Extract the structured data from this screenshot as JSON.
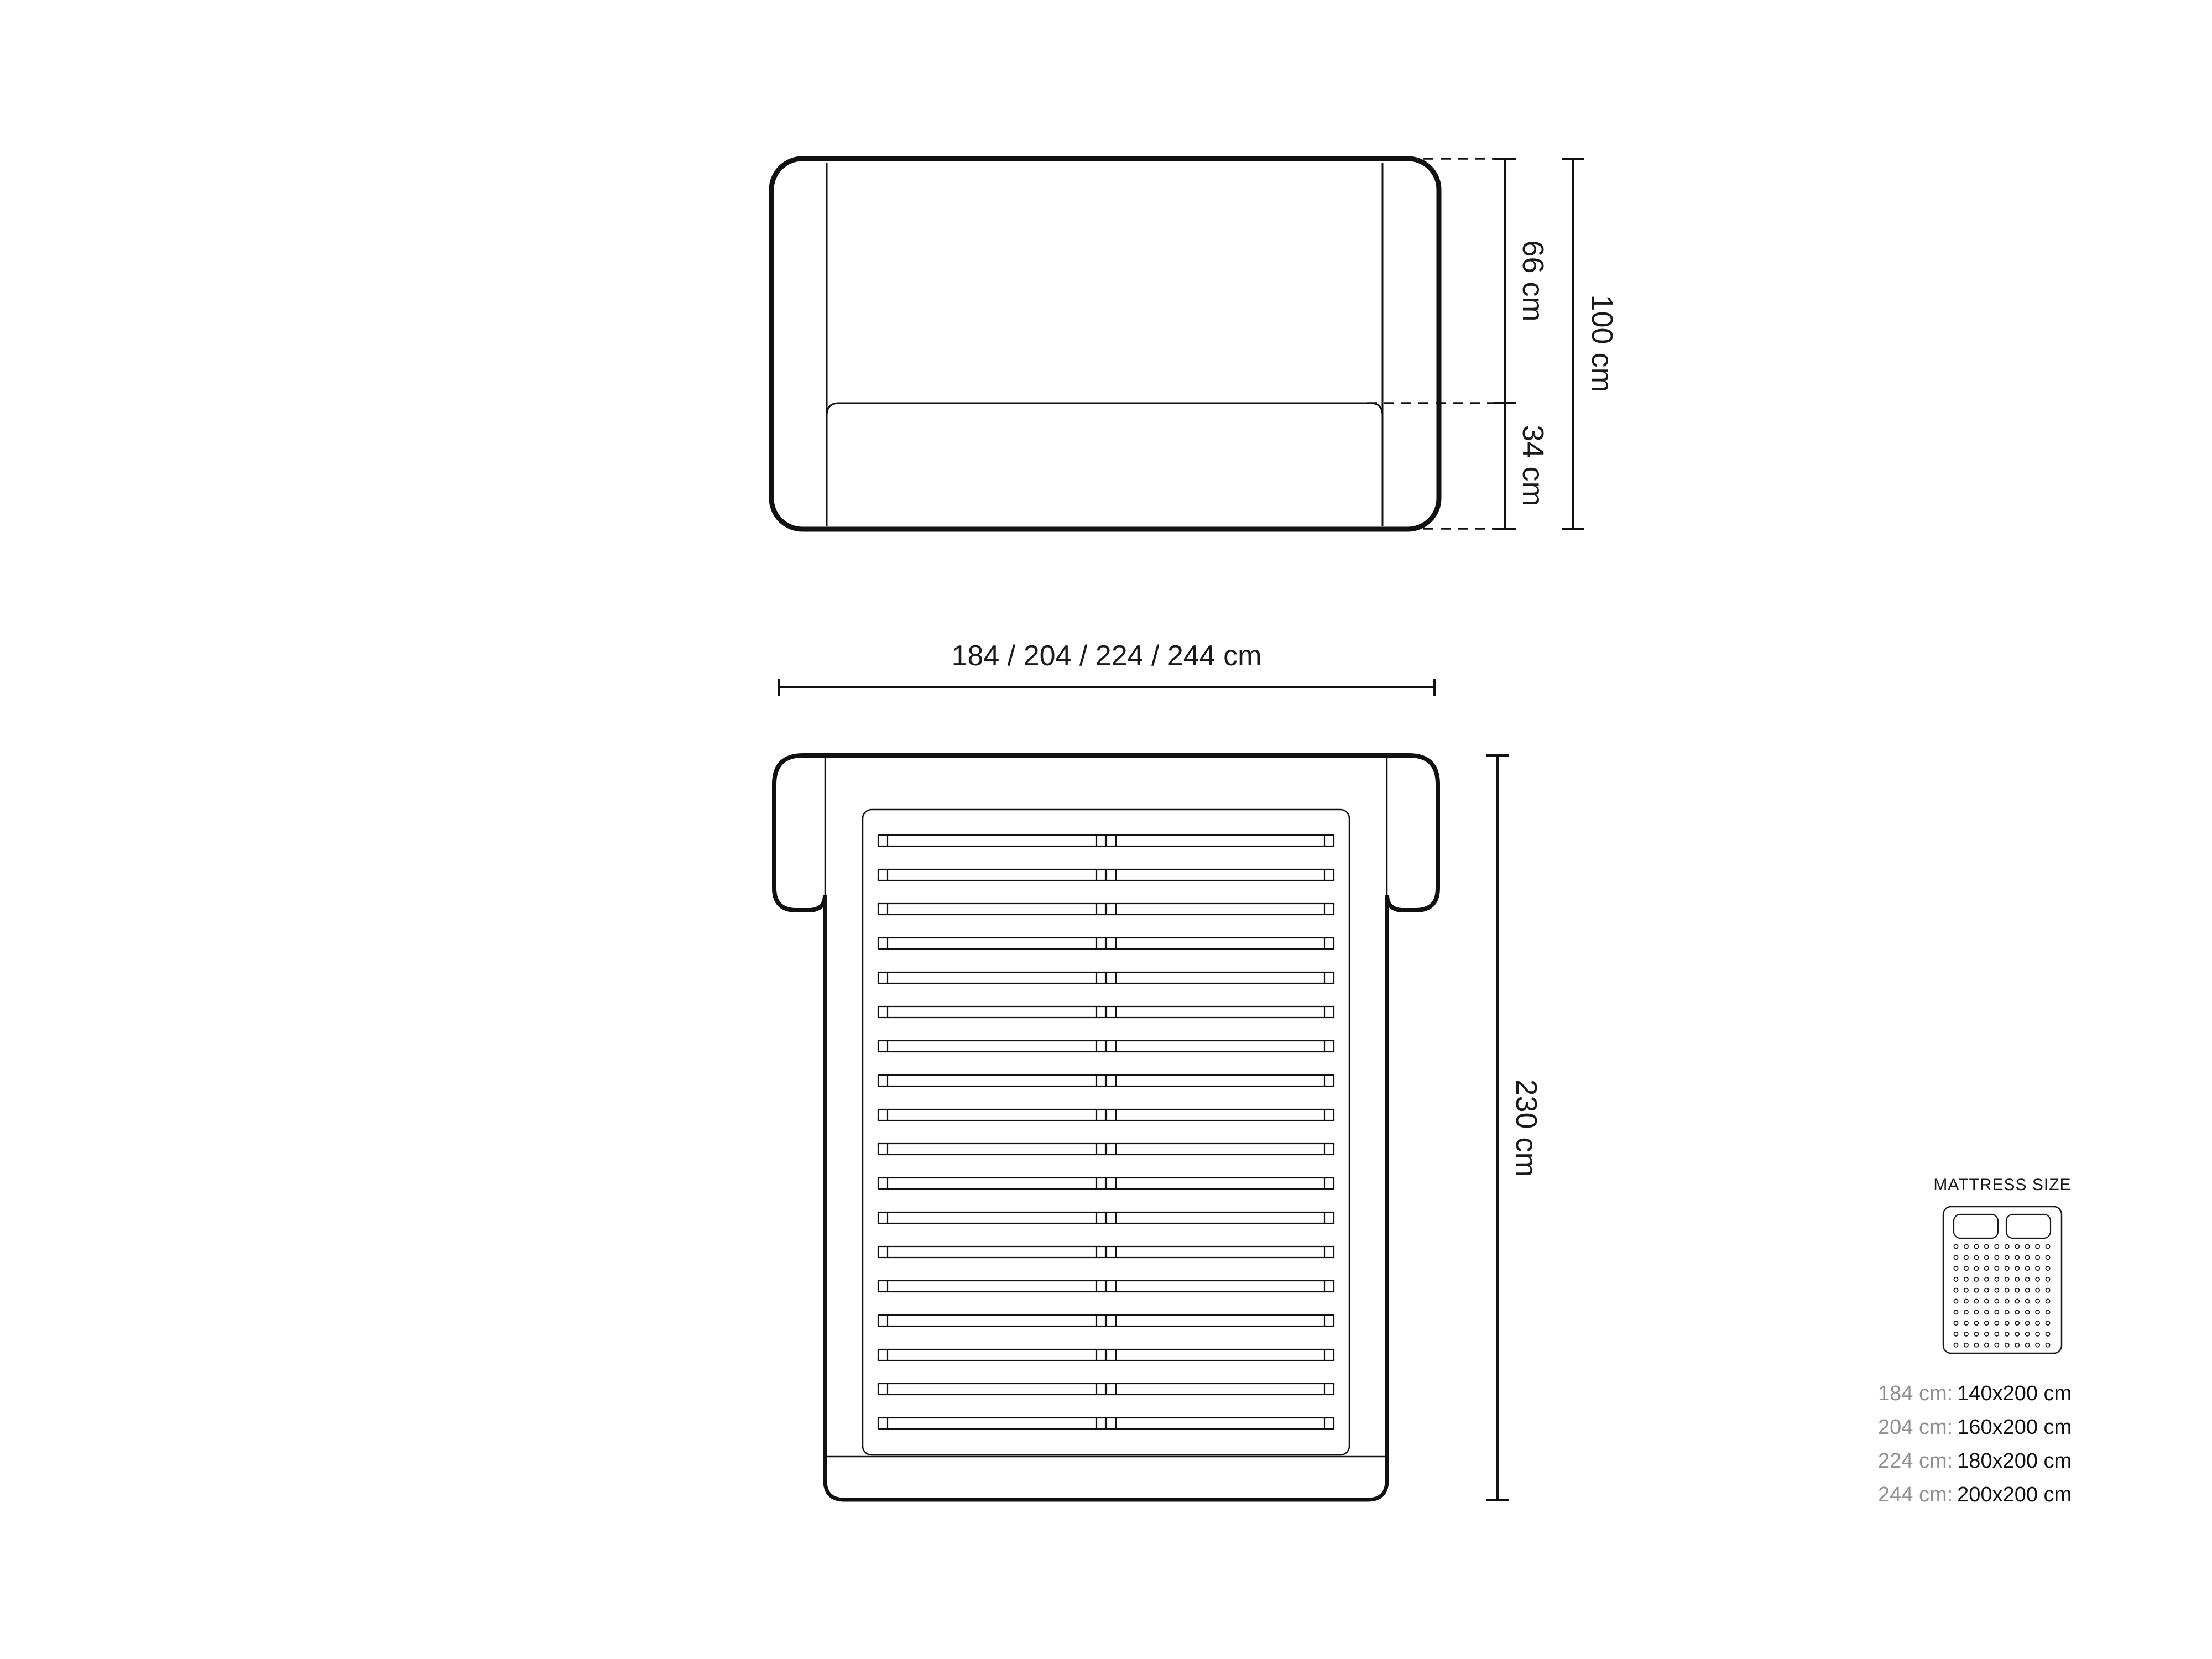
{
  "colors": {
    "line": "#111111",
    "text": "#1a1a1a",
    "muted_text": "#8f8f8f",
    "background": "#ffffff"
  },
  "front_view": {
    "upper_height_label": "66 cm",
    "lower_height_label": "34 cm",
    "total_height_label": "100 cm",
    "width_label": "184 / 204 / 224 / 244 cm"
  },
  "top_view": {
    "depth_label": "230 cm",
    "slat_count": 18
  },
  "legend": {
    "title": "MATTRESS SIZE",
    "icon": {
      "name": "mattress-icon",
      "pillow_count": 2,
      "grid_cols": 10,
      "grid_rows": 10
    },
    "rows": [
      {
        "width": "184 cm:",
        "mattress": "140x200 cm"
      },
      {
        "width": "204 cm:",
        "mattress": "160x200 cm"
      },
      {
        "width": "224 cm:",
        "mattress": "180x200 cm"
      },
      {
        "width": "244 cm:",
        "mattress": "200x200 cm"
      }
    ]
  }
}
